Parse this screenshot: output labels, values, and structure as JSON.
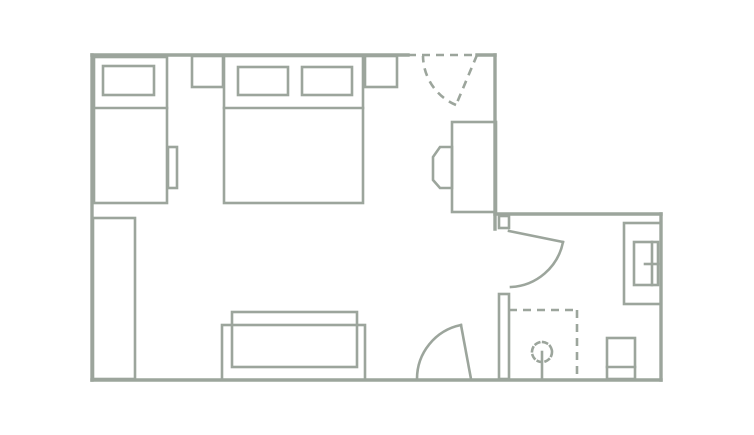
{
  "plan": {
    "canvas": {
      "width": 754,
      "height": 435
    },
    "colors": {
      "line": "#9ca59c",
      "background": "#ffffff"
    },
    "items": [
      {
        "name": "exterior-walls",
        "shapes": [
          {
            "type": "line",
            "cls": "wall",
            "x1": 92,
            "y1": 55,
            "x2": 408,
            "y2": 55
          },
          {
            "type": "line",
            "cls": "wall",
            "x1": 477,
            "y1": 55,
            "x2": 495,
            "y2": 55
          },
          {
            "type": "line",
            "cls": "wall",
            "x1": 495,
            "y1": 55,
            "x2": 495,
            "y2": 229
          },
          {
            "type": "line",
            "cls": "wall",
            "x1": 495,
            "y1": 214,
            "x2": 661,
            "y2": 214
          },
          {
            "type": "line",
            "cls": "wall",
            "x1": 661,
            "y1": 214,
            "x2": 661,
            "y2": 380
          },
          {
            "type": "line",
            "cls": "wall",
            "x1": 92,
            "y1": 380,
            "x2": 661,
            "y2": 380
          },
          {
            "type": "line",
            "cls": "wall",
            "x1": 92,
            "y1": 55,
            "x2": 92,
            "y2": 380
          }
        ]
      },
      {
        "name": "bathroom-partition-wall",
        "shapes": [
          {
            "type": "rect",
            "cls": "furn",
            "x": 499,
            "y": 216,
            "w": 10,
            "h": 12
          },
          {
            "type": "rect",
            "cls": "furn",
            "x": 499,
            "y": 294,
            "w": 10,
            "h": 85
          }
        ]
      },
      {
        "name": "entrance-door-dashed",
        "shapes": [
          {
            "type": "line",
            "cls": "furn",
            "dashed": true,
            "x1": 408,
            "y1": 55,
            "x2": 477,
            "y2": 55
          },
          {
            "type": "line",
            "cls": "furn",
            "dashed": true,
            "x1": 477,
            "y1": 55,
            "x2": 456,
            "y2": 105
          },
          {
            "type": "path",
            "cls": "furn",
            "dashed": true,
            "d": "M 456,105 A 54,54 0 0 1 423,56"
          }
        ]
      },
      {
        "name": "bathroom-door",
        "shapes": [
          {
            "type": "line",
            "cls": "furn",
            "x1": 509,
            "y1": 231,
            "x2": 563,
            "y2": 242
          },
          {
            "type": "path",
            "cls": "furn",
            "d": "M 563,242 A 56,56 0 0 1 511,287"
          }
        ]
      },
      {
        "name": "room-door",
        "shapes": [
          {
            "type": "line",
            "cls": "furn",
            "x1": 471,
            "y1": 379,
            "x2": 461,
            "y2": 325
          },
          {
            "type": "path",
            "cls": "furn",
            "d": "M 417,379 A 55,55 0 0 1 461,325"
          }
        ]
      },
      {
        "name": "single-bed",
        "shapes": [
          {
            "type": "rect",
            "cls": "furn",
            "x": 94,
            "y": 57,
            "w": 73,
            "h": 146
          },
          {
            "type": "rect",
            "cls": "furn",
            "x": 103,
            "y": 66,
            "w": 51,
            "h": 29
          },
          {
            "type": "line",
            "cls": "furn",
            "x1": 94,
            "y1": 108,
            "x2": 167,
            "y2": 108
          },
          {
            "type": "rect",
            "cls": "furn",
            "x": 168,
            "y": 147,
            "w": 9,
            "h": 41
          }
        ]
      },
      {
        "name": "nightstand-left",
        "shapes": [
          {
            "type": "rect",
            "cls": "furn",
            "x": 192,
            "y": 56,
            "w": 31,
            "h": 31
          }
        ]
      },
      {
        "name": "double-bed",
        "shapes": [
          {
            "type": "rect",
            "cls": "furn",
            "x": 224,
            "y": 56,
            "w": 139,
            "h": 147
          },
          {
            "type": "rect",
            "cls": "furn",
            "x": 238,
            "y": 67,
            "w": 50,
            "h": 28
          },
          {
            "type": "rect",
            "cls": "furn",
            "x": 302,
            "y": 67,
            "w": 50,
            "h": 28
          },
          {
            "type": "line",
            "cls": "furn",
            "x1": 224,
            "y1": 108,
            "x2": 363,
            "y2": 108
          }
        ]
      },
      {
        "name": "nightstand-right",
        "shapes": [
          {
            "type": "rect",
            "cls": "furn",
            "x": 365,
            "y": 56,
            "w": 32,
            "h": 31
          }
        ]
      },
      {
        "name": "wardrobe",
        "shapes": [
          {
            "type": "rect",
            "cls": "furn",
            "x": 93,
            "y": 218,
            "w": 42,
            "h": 161
          }
        ]
      },
      {
        "name": "sofa",
        "shapes": [
          {
            "type": "rect",
            "cls": "furn",
            "x": 222,
            "y": 325,
            "w": 143,
            "h": 55
          },
          {
            "type": "rect",
            "cls": "furn",
            "x": 232,
            "y": 312,
            "w": 125,
            "h": 55,
            "fill": "background"
          }
        ]
      },
      {
        "name": "desk",
        "shapes": [
          {
            "type": "rect",
            "cls": "furn",
            "x": 452,
            "y": 122,
            "w": 44,
            "h": 90
          }
        ]
      },
      {
        "name": "desk-chair",
        "shapes": [
          {
            "type": "polygon",
            "cls": "furn",
            "points": "452,147 440,147 433,157 433,180 440,188 452,188"
          }
        ]
      },
      {
        "name": "bathroom-vanity-sink",
        "shapes": [
          {
            "type": "rect",
            "cls": "furn",
            "x": 624,
            "y": 223,
            "w": 37,
            "h": 81
          },
          {
            "type": "rect",
            "cls": "furn",
            "x": 634,
            "y": 242,
            "w": 24,
            "h": 43
          },
          {
            "type": "line",
            "cls": "furn",
            "x1": 652,
            "y1": 242,
            "x2": 652,
            "y2": 285
          },
          {
            "type": "line",
            "cls": "furn",
            "x1": 645,
            "y1": 264,
            "x2": 658,
            "y2": 264
          }
        ]
      },
      {
        "name": "toilet",
        "shapes": [
          {
            "type": "rect",
            "cls": "furn",
            "x": 607,
            "y": 338,
            "w": 28,
            "h": 41
          },
          {
            "type": "line",
            "cls": "furn",
            "x1": 607,
            "y1": 367,
            "x2": 635,
            "y2": 367
          }
        ]
      },
      {
        "name": "shower-enclosure",
        "shapes": [
          {
            "type": "line",
            "cls": "furn",
            "dashed": true,
            "x1": 509,
            "y1": 310,
            "x2": 577,
            "y2": 310
          },
          {
            "type": "line",
            "cls": "furn",
            "dashed": true,
            "x1": 577,
            "y1": 310,
            "x2": 577,
            "y2": 377
          }
        ]
      },
      {
        "name": "shower-head",
        "shapes": [
          {
            "type": "circle",
            "cls": "furn",
            "cx": 542,
            "cy": 352,
            "r": 10,
            "dash": "4 4"
          },
          {
            "type": "line",
            "cls": "furn",
            "x1": 542,
            "y1": 352,
            "x2": 542,
            "y2": 379
          }
        ]
      }
    ]
  }
}
